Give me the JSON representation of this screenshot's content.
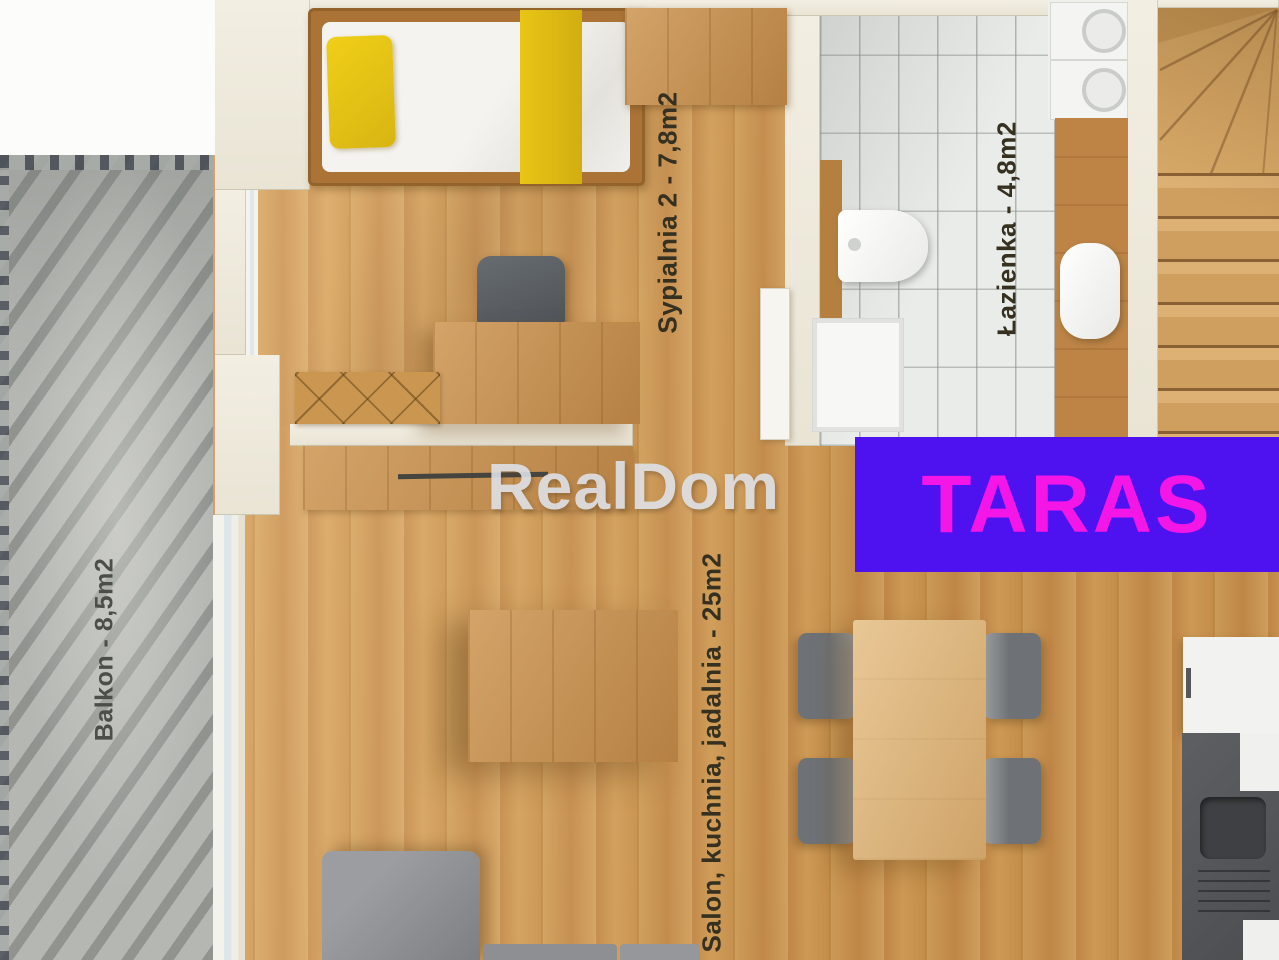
{
  "watermark": {
    "text": "RealDom"
  },
  "overlay": {
    "text": "TARAS",
    "bg_color": "#4e11f0",
    "text_color": "#f316e6",
    "box_style": "background:#4e11f0;color:#f316e6;"
  },
  "rooms": {
    "bedroom2": {
      "label": "Sypialnia 2 - 7,8m2"
    },
    "bathroom": {
      "label": "Łazienka - 4,8m2"
    },
    "balcony": {
      "label": "Balkon - 8,5m2"
    },
    "living": {
      "label": "Salon, kuchnia, jadalnia - 25m2"
    }
  },
  "colors": {
    "wood_floor": "#cf9a58",
    "tile_floor": "#eaecea",
    "balcony_concrete": "#b5b7b3",
    "wall_cream": "#efebde",
    "overlay_bg": "#4e11f0",
    "overlay_text": "#f316e6",
    "label_text": "#35301f"
  }
}
